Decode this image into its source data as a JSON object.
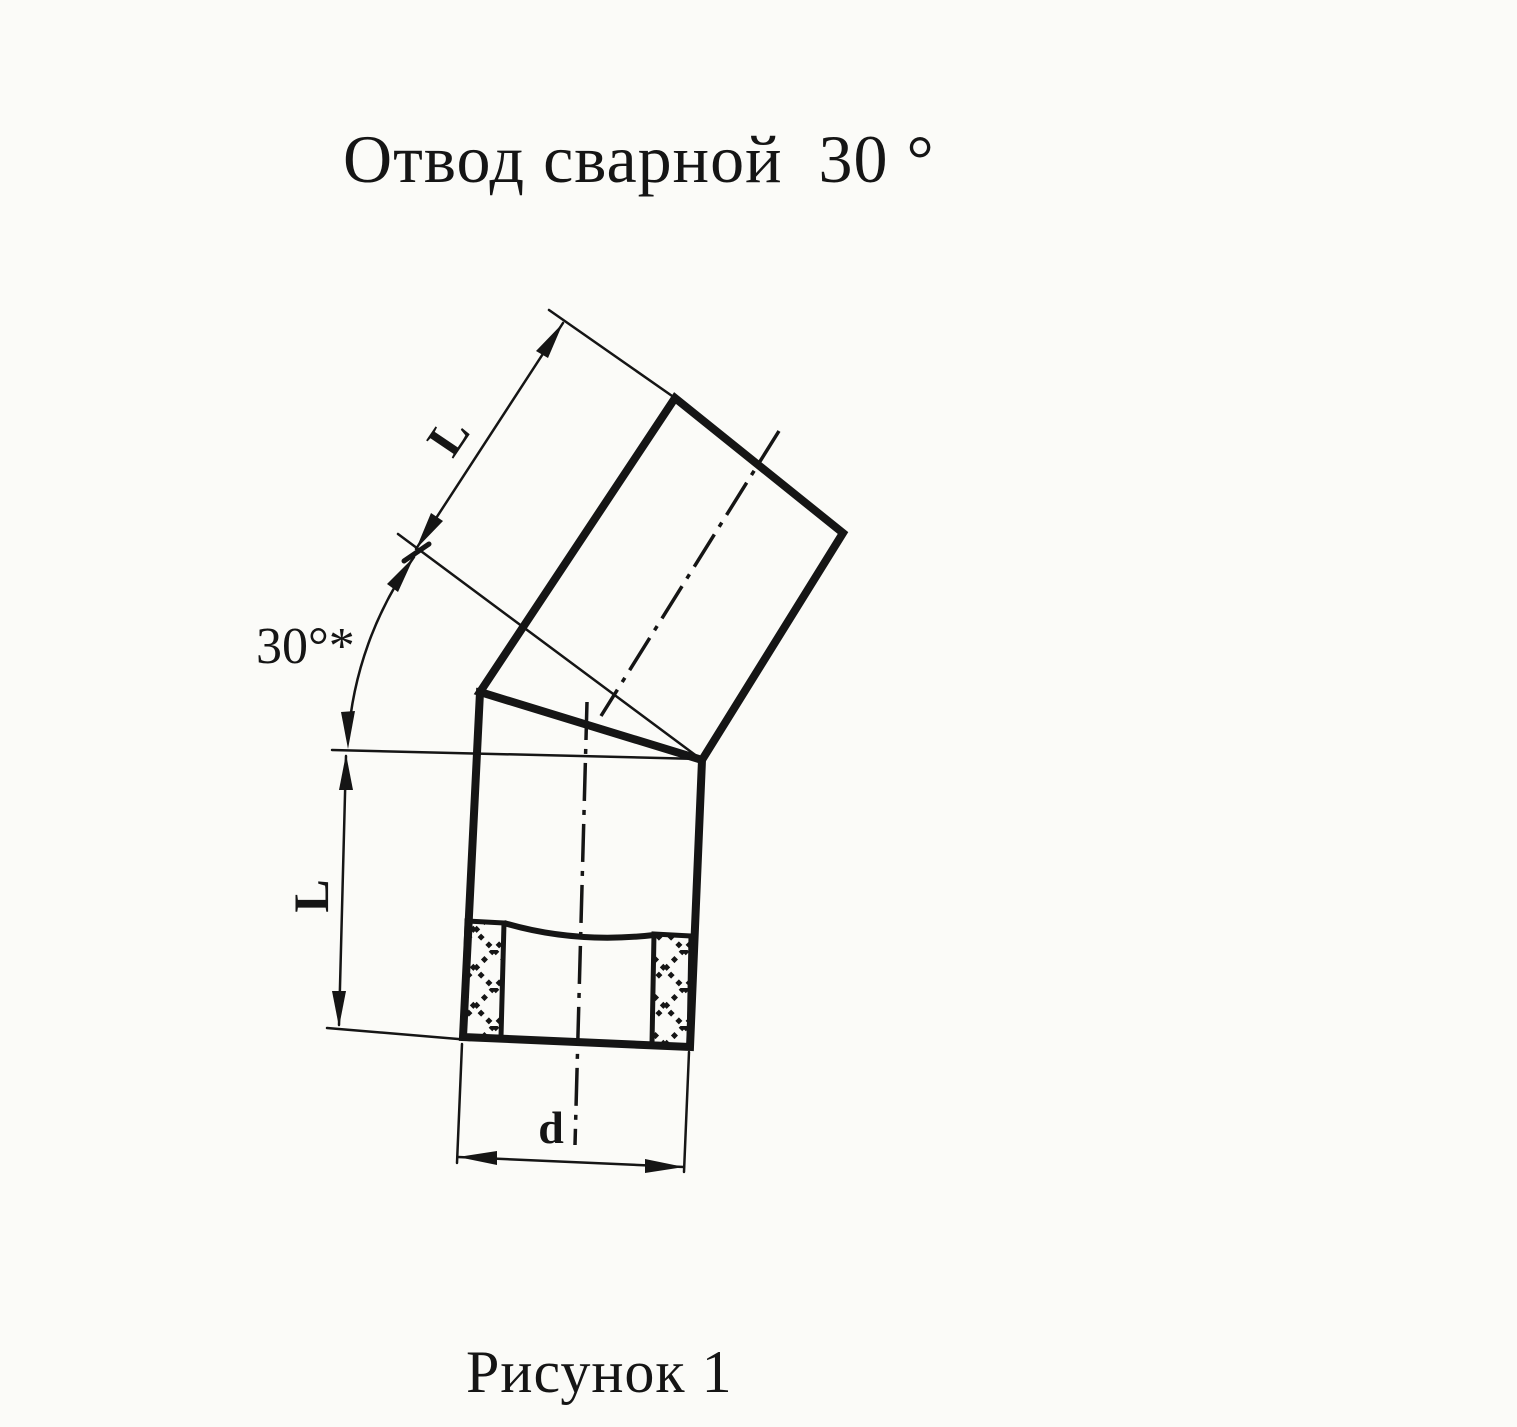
{
  "page": {
    "title": "Отвод сварной  30 °",
    "caption": "Рисунок 1"
  },
  "drawing": {
    "labels": {
      "upper_length": "L",
      "angle": "30°*",
      "lower_length": "L",
      "diameter": "d"
    },
    "colors": {
      "ink": "#151515",
      "paper": "#fbfbf8"
    }
  }
}
